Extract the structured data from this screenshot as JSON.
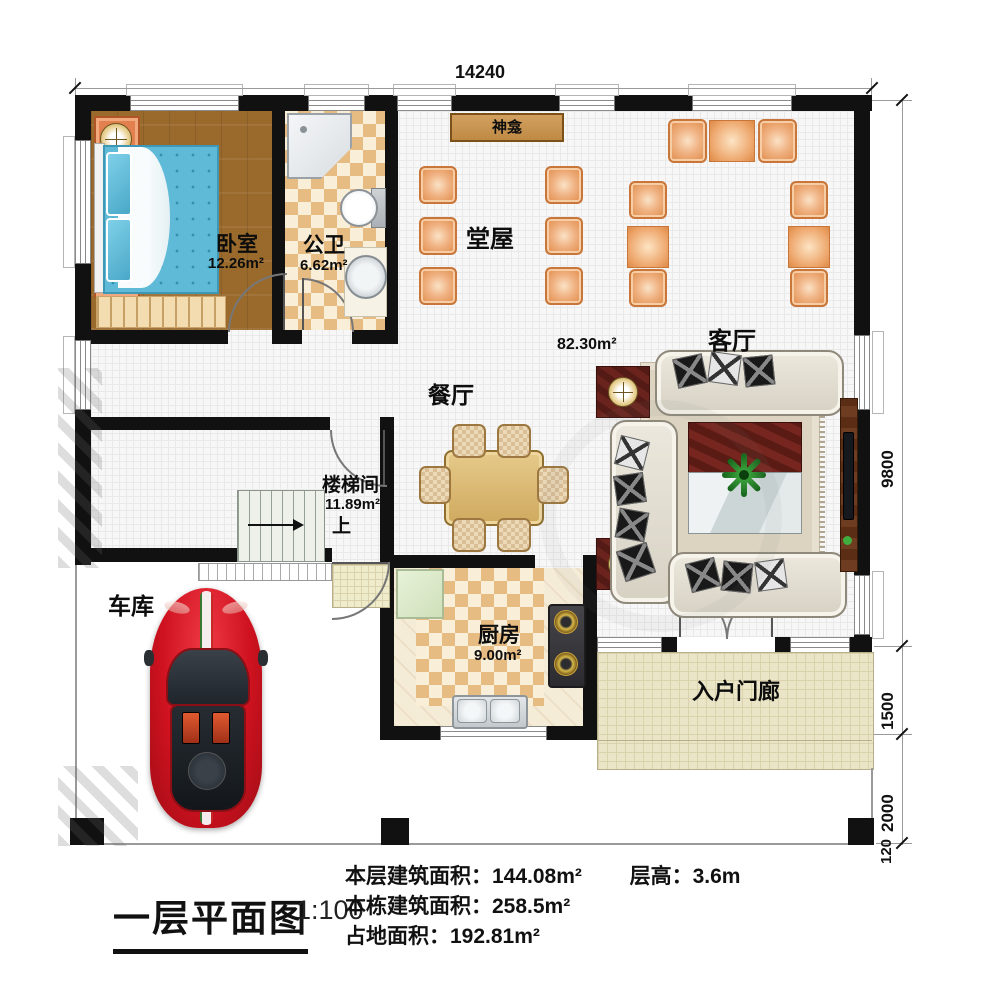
{
  "plan": {
    "title": "一层平面图",
    "scale_label": "1:100",
    "stats": {
      "line1a": "本层建筑面积：144.08m²",
      "line1b": "层高：3.6m",
      "line2": "本栋建筑面积：258.5m²",
      "line3": "占地面积：192.81m²"
    }
  },
  "dimensions": {
    "width_total": "14240",
    "right_side": [
      "9800",
      "1500",
      "2000",
      "120"
    ]
  },
  "rooms": {
    "bedroom": {
      "name": "卧室",
      "area": "12.26m²"
    },
    "bathroom": {
      "name": "公卫",
      "area": "6.62m²"
    },
    "hall": {
      "name": "堂屋"
    },
    "shrine": {
      "name": "神龛"
    },
    "open_area": {
      "area": "82.30m²"
    },
    "living": {
      "name": "客厅"
    },
    "dining": {
      "name": "餐厅"
    },
    "stairwell": {
      "name": "楼梯间",
      "area": "11.89m²",
      "direction": "上"
    },
    "garage": {
      "name": "车库"
    },
    "kitchen": {
      "name": "厨房",
      "area": "9.00m²"
    },
    "porch": {
      "name": "入户门廊"
    }
  },
  "colors": {
    "wall": "#111111",
    "chair_orange": "#e8945a",
    "bed_blue": "#5fbad8",
    "wood_floor": "#9a6a2c",
    "car_red": "#d01220",
    "checker_tan": "#e7bc83"
  }
}
